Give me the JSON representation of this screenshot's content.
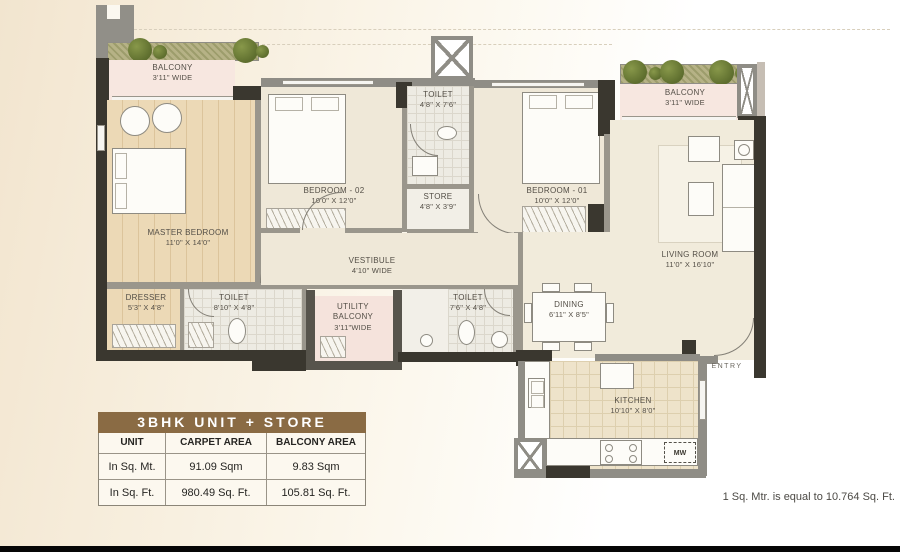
{
  "plan": {
    "rooms": {
      "balcony_left": {
        "label": "BALCONY",
        "dim": "3'11\" WIDE"
      },
      "master_bedroom": {
        "label": "MASTER BEDROOM",
        "dim": "11'0\" X 14'0\""
      },
      "bedroom_02": {
        "label": "BEDROOM - 02",
        "dim": "10'0\" X 12'0\""
      },
      "toilet_top": {
        "label": "TOILET",
        "dim": "4'8\" X 7'6\""
      },
      "store": {
        "label": "STORE",
        "dim": "4'8\" X 3'9\""
      },
      "bedroom_01": {
        "label": "BEDROOM - 01",
        "dim": "10'0\" X 12'0\""
      },
      "balcony_right": {
        "label": "BALCONY",
        "dim": "3'11\" WIDE"
      },
      "living_room": {
        "label": "LIVING ROOM",
        "dim": "11'0\" X 16'10\""
      },
      "vestibule": {
        "label": "VESTIBULE",
        "dim": "4'10\" WIDE"
      },
      "dresser": {
        "label": "DRESSER",
        "dim": "5'3\" X 4'8\""
      },
      "toilet_master": {
        "label": "TOILET",
        "dim": "8'10\" X 4'8\""
      },
      "utility_balcony": {
        "label": "UTILITY BALCONY",
        "dim": "3'11\"WIDE"
      },
      "toilet_common": {
        "label": "TOILET",
        "dim": "7'6\" X 4'8\""
      },
      "dining": {
        "label": "DINING",
        "dim": "6'11\" X 8'5\""
      },
      "kitchen": {
        "label": "KITCHEN",
        "dim": "10'10\" X 8'0\""
      },
      "entry": {
        "label": "ENTRY"
      },
      "microwave": {
        "label": "MW"
      }
    }
  },
  "table": {
    "title": "3BHK UNIT + STORE",
    "headers": [
      "UNIT",
      "CARPET AREA",
      "BALCONY AREA"
    ],
    "rows": [
      [
        "In Sq. Mt.",
        "91.09 Sqm",
        "9.83 Sqm"
      ],
      [
        "In Sq. Ft.",
        "980.49 Sq. Ft.",
        "105.81 Sq. Ft."
      ]
    ]
  },
  "footnote": "1 Sq. Mtr. is equal to 10.764 Sq. Ft.",
  "colors": {
    "table_header_bg": "#8a6b44",
    "wall_dark": "#3a372f",
    "wall_gray": "#8f8d86",
    "balcony_pink": "#f7e7e0",
    "wood_floor": "#ecd9b6",
    "planter_green": "#6d7a35"
  }
}
